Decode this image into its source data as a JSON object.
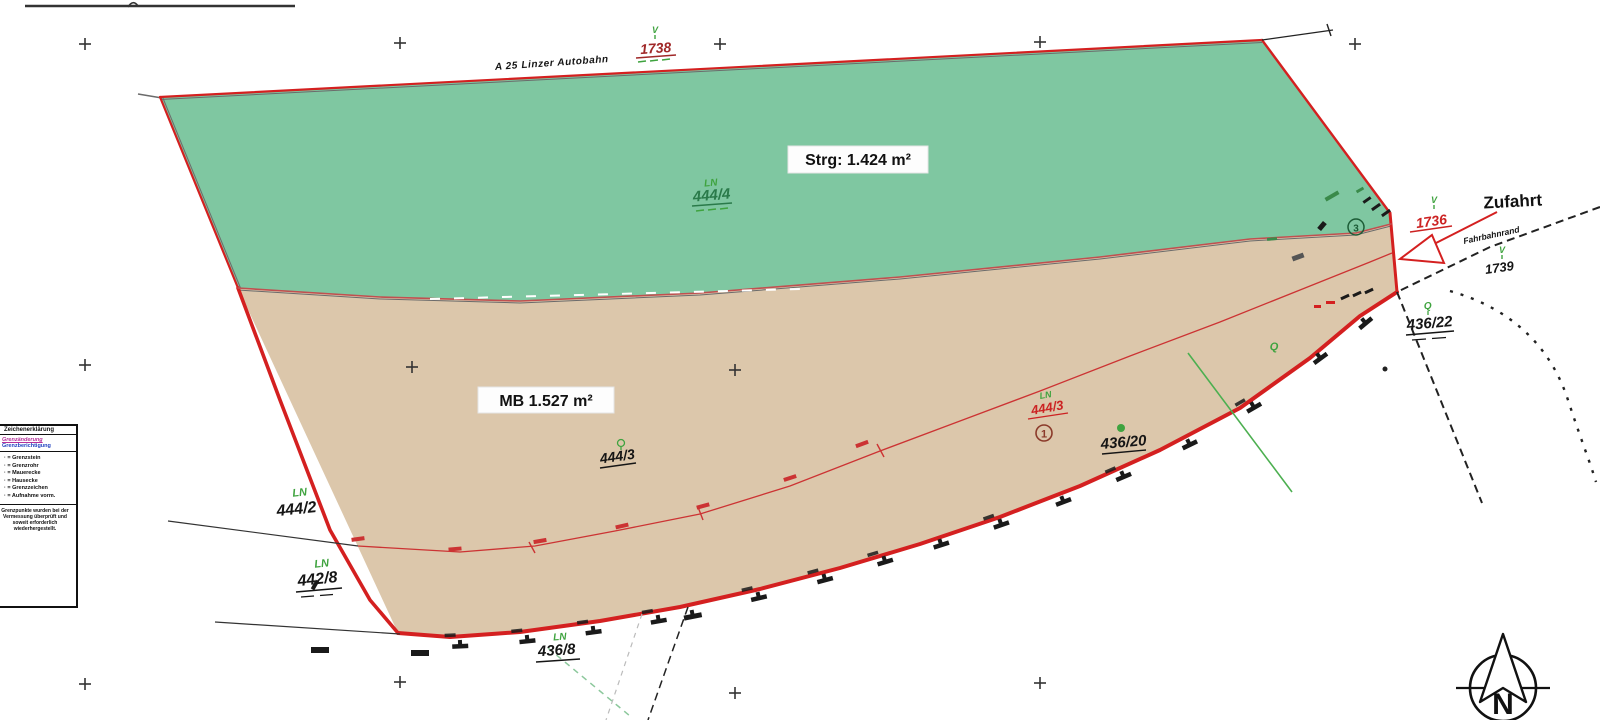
{
  "labels": {
    "autobahn": "A 25 Linzer Autobahn",
    "strg_area": "Strg: 1.424 m²",
    "mb_area": "MB 1.527 m²",
    "zufahrt": "Zufahrt",
    "fahrbahnrand": "Fahrbahnrand"
  },
  "points": {
    "p1738": "1738",
    "p1736": "1736",
    "p1739": "1739",
    "v": "V",
    "circle_1": "1",
    "circle_3": "3"
  },
  "parcels": {
    "p444_4": "444/4",
    "p444_3": "444/3",
    "p444_3_new": "444/3",
    "p444_2": "444/2",
    "p442_8": "442/8",
    "p436_8": "436/8",
    "p436_20": "436/20",
    "p436_22": "436/22",
    "ln": "LN",
    "q": "Q"
  },
  "compass": {
    "north": "N"
  },
  "legend": {
    "title": "Zeichenerklärung",
    "magenta_item": "Grenzänderung",
    "blue_item": "Grenzberichtigung",
    "items": [
      "· = Grenzstein",
      "· = Grenzrohr",
      "· = Mauerecke",
      "· = Hausecke",
      "· = Grenzzeichen",
      "· = Aufnahme vorm."
    ],
    "note": "Grenzpunkte wurden bei der Vermessung überprüft und soweit erforderlich wiederhergestellt."
  },
  "colors": {
    "parcel_green": "#7fc7a1",
    "parcel_tan": "#dcc7ab",
    "boundary_red": "#d42020",
    "new_boundary_red": "#cc3333",
    "green_text": "#3fa33f",
    "dark_green_text": "#2a7a4a",
    "legend_magenta": "#b5309a",
    "legend_blue": "#2040c0"
  }
}
